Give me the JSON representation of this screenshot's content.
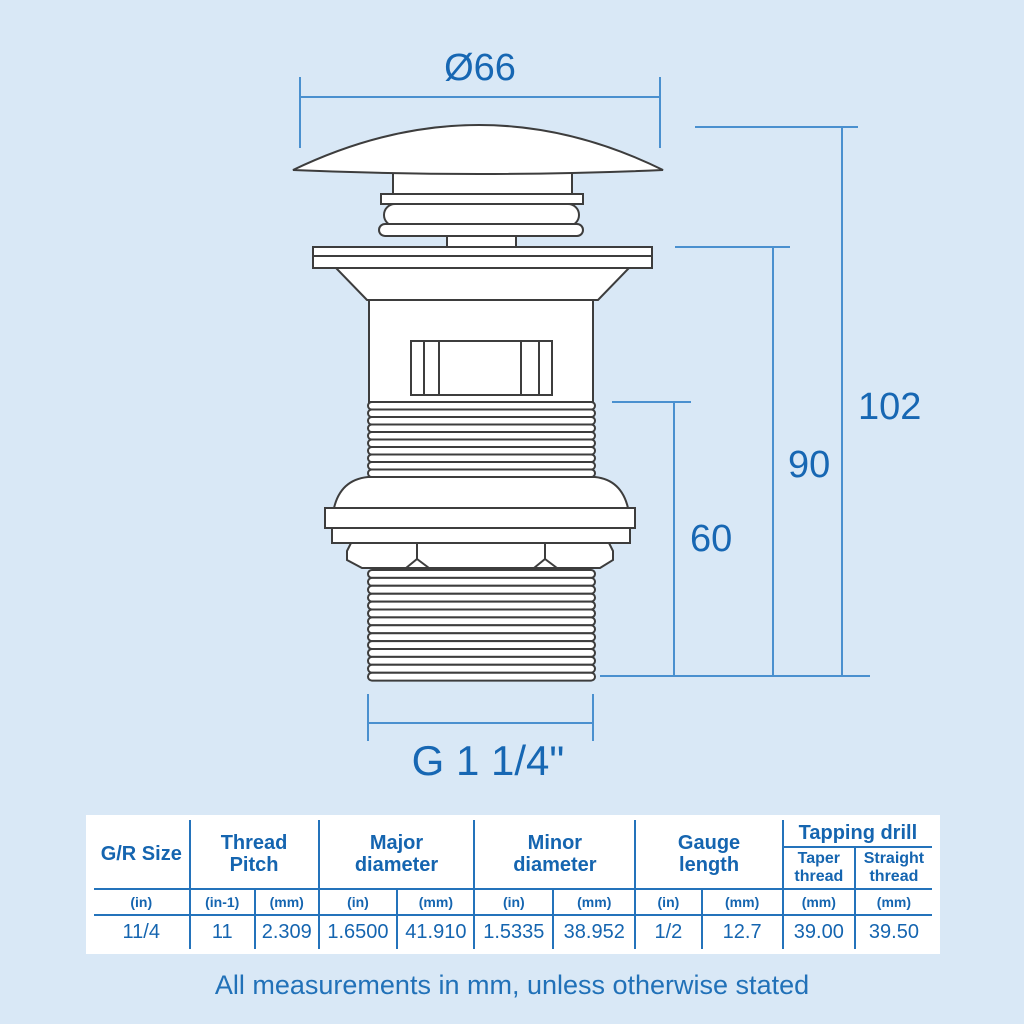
{
  "colors": {
    "background": "#d9e8f6",
    "text_blue": "#1767b3",
    "dimension_line": "#4a90cf",
    "drawing_line": "#3d3d3d",
    "table_grid": "#2473bb",
    "table_background": "#ffffff"
  },
  "drawing": {
    "dim_diameter": "Ø66",
    "dim_total_height": "102",
    "dim_body_height": "90",
    "dim_thread_height": "60",
    "dim_thread_size": "G 1 1/4\""
  },
  "table": {
    "headers": {
      "gr_size": "G/R Size",
      "thread_pitch": [
        "Thread",
        "Pitch"
      ],
      "major_diameter": [
        "Major",
        "diameter"
      ],
      "minor_diameter": [
        "Minor",
        "diameter"
      ],
      "gauge_length": [
        "Gauge",
        "length"
      ],
      "tapping_drill": "Tapping drill",
      "taper_thread": [
        "Taper",
        "thread"
      ],
      "straight_thread": [
        "Straight",
        "thread"
      ]
    },
    "units": [
      "(in)",
      "(in-1)",
      "(mm)",
      "(in)",
      "(mm)",
      "(in)",
      "(mm)",
      "(in)",
      "(mm)",
      "(mm)",
      "(mm)"
    ],
    "values": [
      "11/4",
      "11",
      "2.309",
      "1.6500",
      "41.910",
      "1.5335",
      "38.952",
      "1/2",
      "12.7",
      "39.00",
      "39.50"
    ]
  },
  "footer": {
    "note": "All measurements in mm, unless otherwise stated"
  }
}
